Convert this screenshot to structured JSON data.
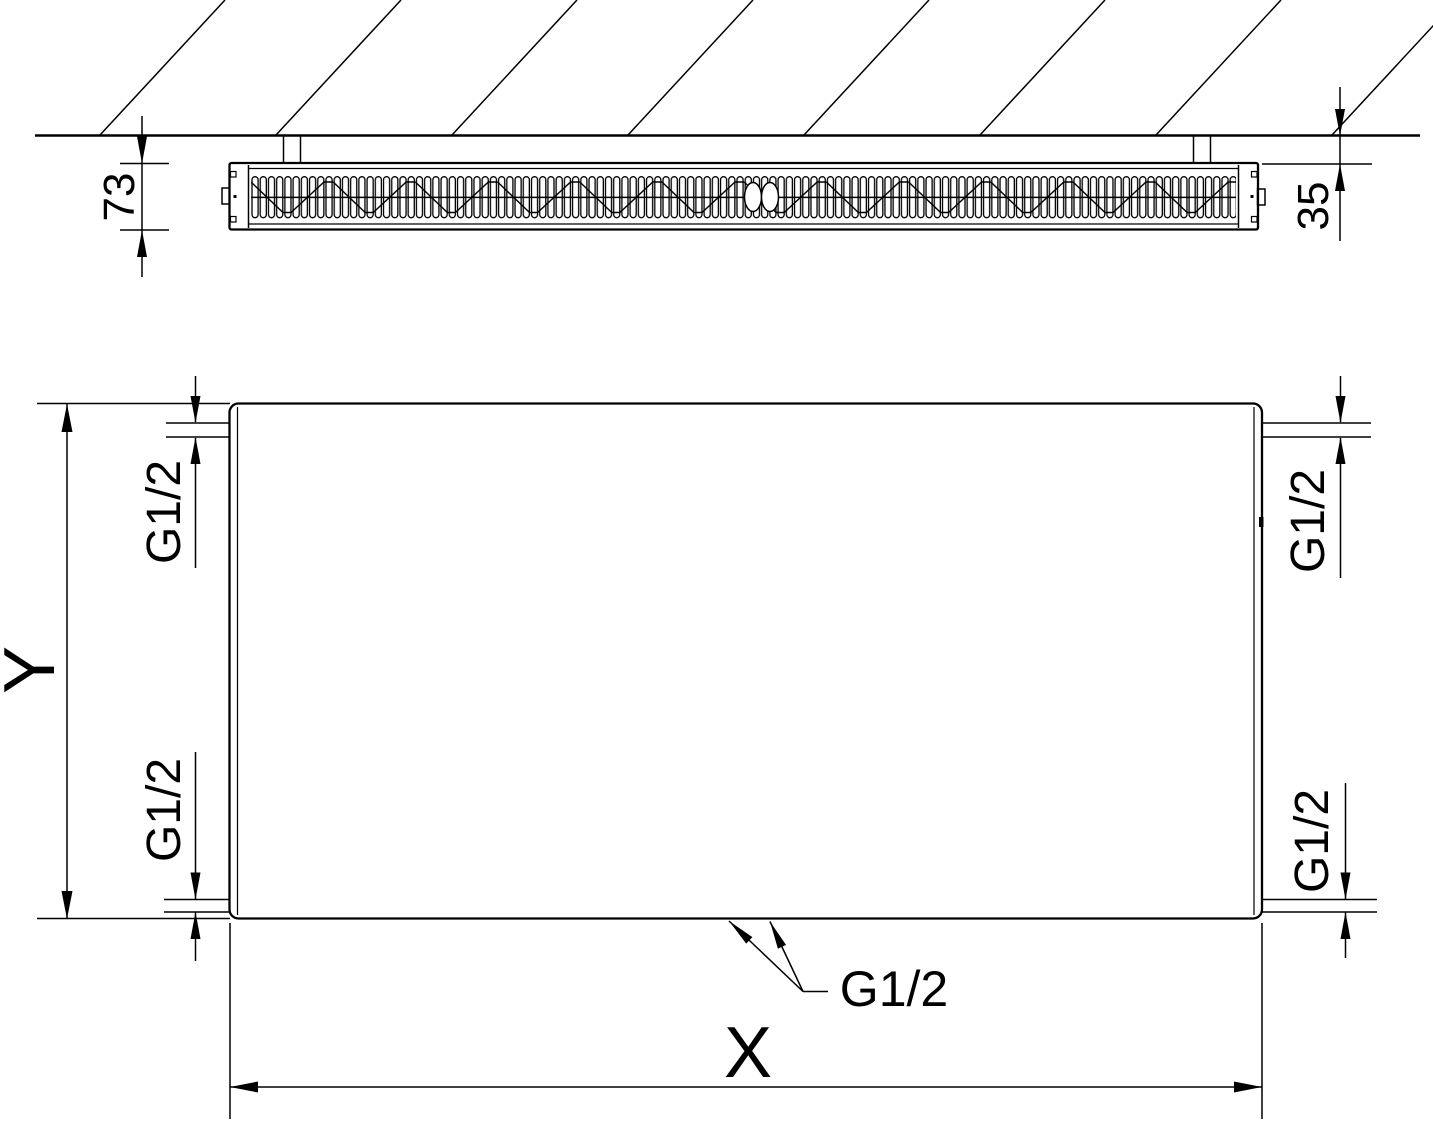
{
  "colors": {
    "line": "#000000",
    "background": "#ffffff"
  },
  "section_view": {
    "depth_dimension": "73",
    "wall_clearance_dimension": "35"
  },
  "front_view": {
    "height_dimension": "Y",
    "width_dimension": "X",
    "connection_top_left": "G1/2",
    "connection_bottom_left": "G1/2",
    "connection_top_right": "G1/2",
    "connection_bottom_right": "G1/2",
    "connection_bottom_center": "G1/2"
  }
}
